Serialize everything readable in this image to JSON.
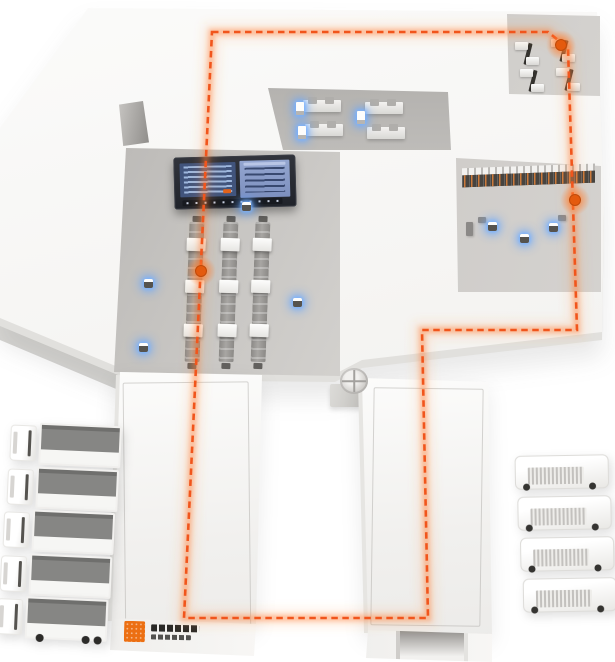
{
  "scene": {
    "type": "isometric-smart-factory-illustration",
    "colors": {
      "accent_orange": "#f1551c",
      "glow_orange": "#ff8c42",
      "marker_orange": "#e45a0e",
      "blue_glow": "#64a5ff",
      "floor": "#f6f5f3",
      "pocket_gray": "#c3c1be",
      "screen_frame": "#262932",
      "screen_panel_left": "#41547c",
      "screen_panel_right": "#8496c2",
      "rack_body": "#45423e",
      "rack_goods_dot": "#e4843a",
      "truck_roof_gray": "#868684"
    },
    "route": {
      "points": [
        [
          212,
          32
        ],
        [
          548,
          32
        ],
        [
          568,
          48
        ],
        [
          577,
          330
        ],
        [
          422,
          330
        ],
        [
          428,
          618
        ],
        [
          184,
          618
        ]
      ],
      "markers": [
        [
          561,
          45
        ],
        [
          575,
          200
        ],
        [
          201,
          271
        ]
      ],
      "dash_pattern": "6.5 4.5"
    },
    "sensors": [
      [
        148,
        283
      ],
      [
        143,
        347
      ],
      [
        297,
        302
      ],
      [
        246,
        206
      ],
      [
        524,
        238
      ],
      [
        492,
        226
      ],
      [
        553,
        227
      ]
    ],
    "counts": {
      "dock_panels": 8,
      "conveyor_lines": 3,
      "conveyor_boxes_per_line": 3,
      "rack_rows_upper": 2,
      "rack_columns_lower": 7,
      "machines_top_right": 4,
      "office_desks": 4,
      "office_terminals": 3,
      "trucks_left": 5,
      "trucks_right": 4
    },
    "logo": {
      "mark": "orange-grid-square",
      "text_legible": false
    }
  }
}
